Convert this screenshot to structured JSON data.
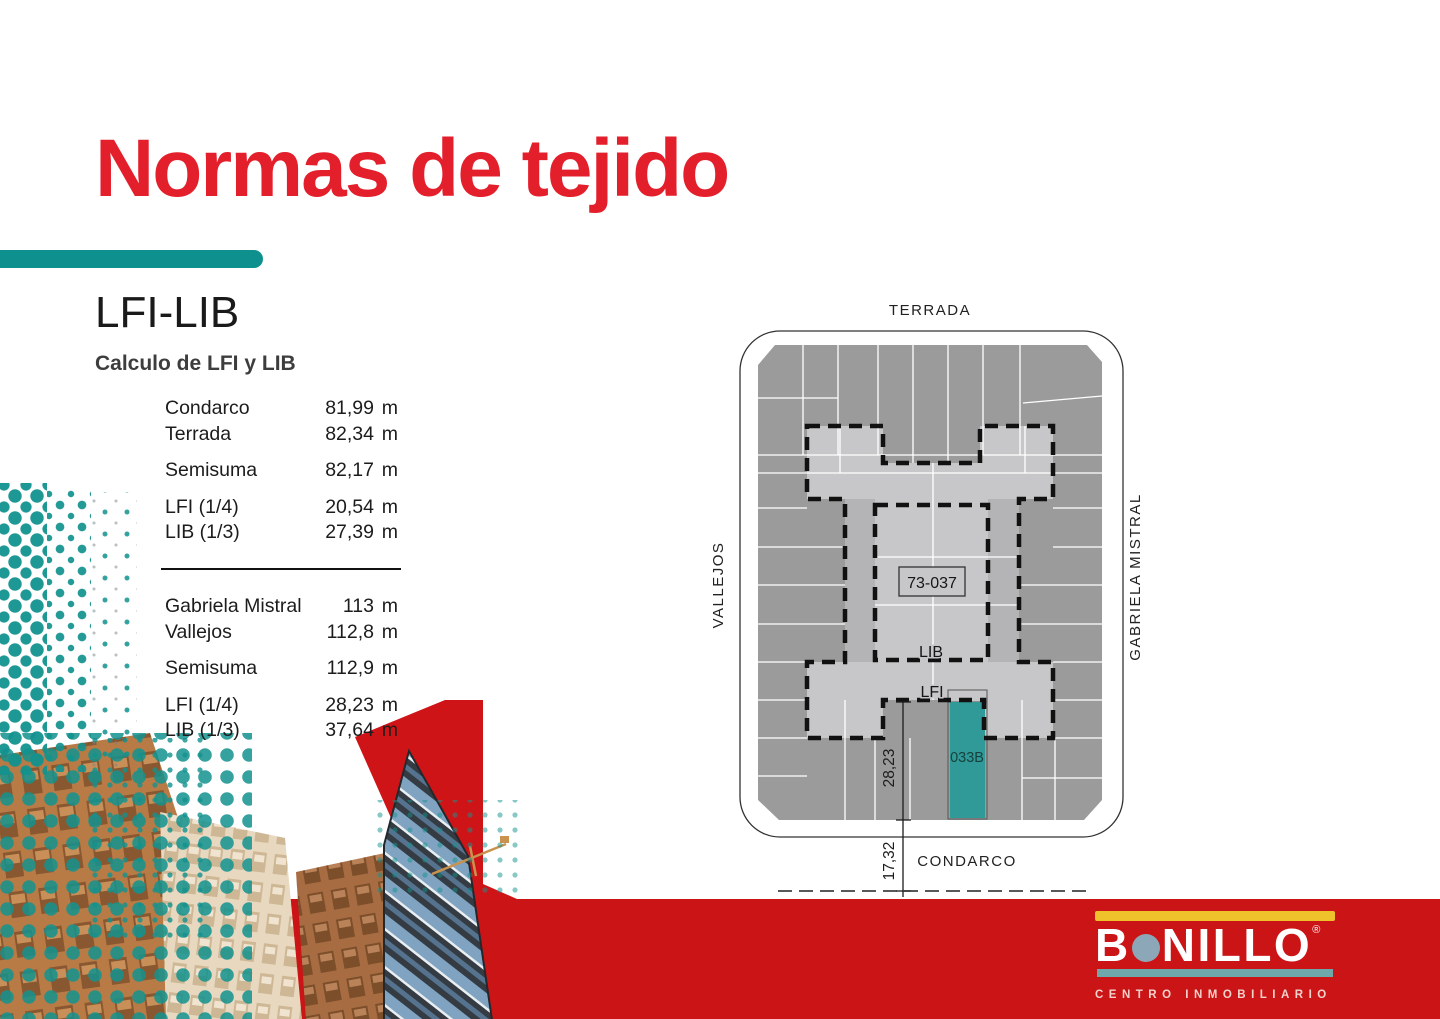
{
  "title": "Normas de tejido",
  "section": {
    "heading": "LFI-LIB",
    "subheading": "Calculo de LFI y LIB"
  },
  "calc_table": {
    "group1": [
      {
        "label": "Condarco",
        "value": "81,99",
        "unit": "m"
      },
      {
        "label": "Terrada",
        "value": "82,34",
        "unit": "m"
      },
      {
        "label": "Semisuma",
        "value": "82,17",
        "unit": "m"
      },
      {
        "label": "LFI (1/4)",
        "value": "20,54",
        "unit": "m"
      },
      {
        "label": "LIB (1/3)",
        "value": "27,39",
        "unit": "m"
      }
    ],
    "group2": [
      {
        "label": "Gabriela Mistral",
        "value": "113",
        "unit": "m"
      },
      {
        "label": "Vallejos",
        "value": "112,8",
        "unit": "m"
      },
      {
        "label": "Semisuma",
        "value": "112,9",
        "unit": "m"
      },
      {
        "label": "LFI (1/4)",
        "value": "28,23",
        "unit": "m"
      },
      {
        "label": "LIB (1/3)",
        "value": "37,64",
        "unit": "m"
      }
    ]
  },
  "map": {
    "streets": {
      "top": "TERRADA",
      "left": "VALLEJOS",
      "right": "GABRIELA MISTRAL",
      "bottom": "CONDARCO"
    },
    "parcel_id": "73-037",
    "lib_label": "LIB",
    "lfi_label": "LFI",
    "highlight_parcel": "033B",
    "dim_upper": "28,23",
    "dim_lower": "17,32",
    "colors": {
      "parcel_dark": "#9b9b9b",
      "envelope_light": "#c7c7c9",
      "envelope_mid": "#b4b4b6",
      "highlight_teal": "#2f9a97"
    }
  },
  "logo": {
    "letters_before_dot": "B",
    "letters_after_dot": "NILLO",
    "registered": "®",
    "tagline": "CENTRO INMOBILIARIO",
    "colors": {
      "bg": "#CB1416",
      "yellow": "#EFC22B",
      "dot": "#8CA7B7",
      "teal_bar": "#6FA8AB"
    }
  },
  "accent": {
    "teal": "#0E918E",
    "title_red": "#E41F2C",
    "band_red": "#CB1416"
  }
}
